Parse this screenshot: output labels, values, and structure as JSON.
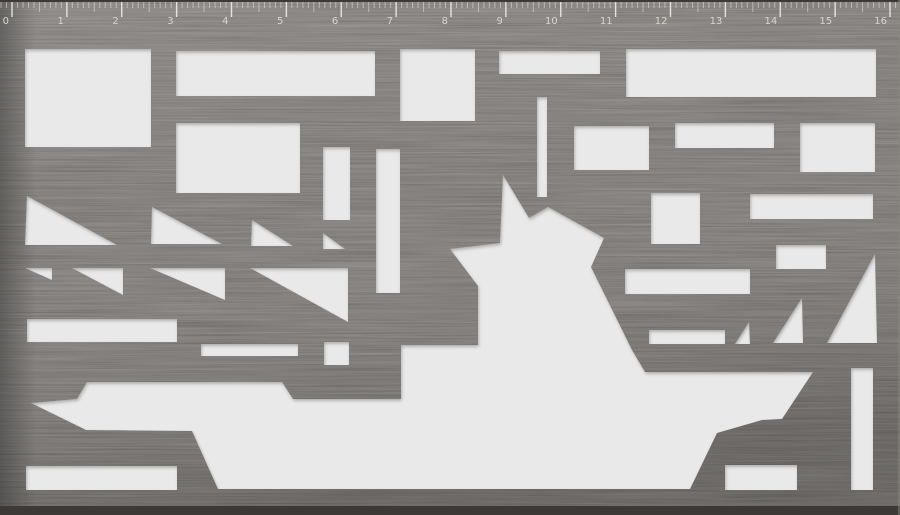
{
  "colors": {
    "plate_base": "#5e5954",
    "plate_edge_dark": "#3c3936",
    "plate_edge_light": "#8a857e",
    "cutout": "#e9e9e9",
    "ruler_tick_major": "rgba(238,236,230,0.92)",
    "ruler_tick_minor": "rgba(230,228,222,0.55)",
    "ruler_text": "#d8d6d1"
  },
  "ruler": {
    "labels": [
      "0",
      "1",
      "2",
      "3",
      "4",
      "5",
      "6",
      "7",
      "8",
      "9",
      "10",
      "11",
      "12",
      "13",
      "14",
      "15",
      "16"
    ],
    "origin_x": 12,
    "unit_px": 54.875,
    "minor_per_unit": 10,
    "major_h": 17,
    "medium_h": 12,
    "minor_h": 8,
    "label_y": 24
  },
  "stencil": {
    "rects": [
      {
        "x": 25,
        "y": 49,
        "w": 126,
        "h": 98
      },
      {
        "x": 176,
        "y": 51,
        "w": 199,
        "h": 45
      },
      {
        "x": 400,
        "y": 49,
        "w": 75,
        "h": 72
      },
      {
        "x": 499,
        "y": 51,
        "w": 101,
        "h": 23
      },
      {
        "x": 626,
        "y": 49,
        "w": 250,
        "h": 48
      },
      {
        "x": 176,
        "y": 123,
        "w": 124,
        "h": 70
      },
      {
        "x": 537,
        "y": 97,
        "w": 10,
        "h": 100
      },
      {
        "x": 574,
        "y": 126,
        "w": 75,
        "h": 44
      },
      {
        "x": 675,
        "y": 123,
        "w": 99,
        "h": 25
      },
      {
        "x": 800,
        "y": 123,
        "w": 75,
        "h": 49
      },
      {
        "x": 651,
        "y": 193,
        "w": 49,
        "h": 51
      },
      {
        "x": 750,
        "y": 194,
        "w": 123,
        "h": 25
      },
      {
        "x": 776,
        "y": 245,
        "w": 50,
        "h": 24
      },
      {
        "x": 625,
        "y": 269,
        "w": 125,
        "h": 25
      },
      {
        "x": 649,
        "y": 330,
        "w": 76,
        "h": 14
      },
      {
        "x": 323,
        "y": 147,
        "w": 27,
        "h": 73
      },
      {
        "x": 376,
        "y": 149,
        "w": 24,
        "h": 144
      },
      {
        "x": 27,
        "y": 319,
        "w": 150,
        "h": 23
      },
      {
        "x": 201,
        "y": 344,
        "w": 97,
        "h": 12
      },
      {
        "x": 324,
        "y": 342,
        "w": 25,
        "h": 23
      },
      {
        "x": 26,
        "y": 466,
        "w": 151,
        "h": 24
      },
      {
        "x": 725,
        "y": 465,
        "w": 72,
        "h": 25
      },
      {
        "x": 851,
        "y": 368,
        "w": 22,
        "h": 122
      }
    ],
    "triangles": [
      {
        "points": "27,196 25,245 117,245"
      },
      {
        "points": "152,207 151,244 222,244"
      },
      {
        "points": "252,220 251,246 293,246"
      },
      {
        "points": "25,268 52,268 52,280"
      },
      {
        "points": "72,268 123,268 123,295"
      },
      {
        "points": "150,268 225,268 225,300"
      },
      {
        "points": "250,268 348,268 348,322"
      },
      {
        "points": "323,233 323,249 345,249"
      },
      {
        "points": "749,322 735,344 750,344"
      },
      {
        "points": "802,298 773,343 803,343"
      },
      {
        "points": "875,254 827,343 877,343"
      }
    ],
    "ship": {
      "points": "31,403 77,399 87,382 282,382 293,399 401,399 401,345 478,345 478,286 450,249 500,243 503,175 529,218 548,207 604,238 591,267 632,350 645,372 813,372 782,419 762,420 717,433 690,489 218,489 192,431 86,430"
    }
  }
}
